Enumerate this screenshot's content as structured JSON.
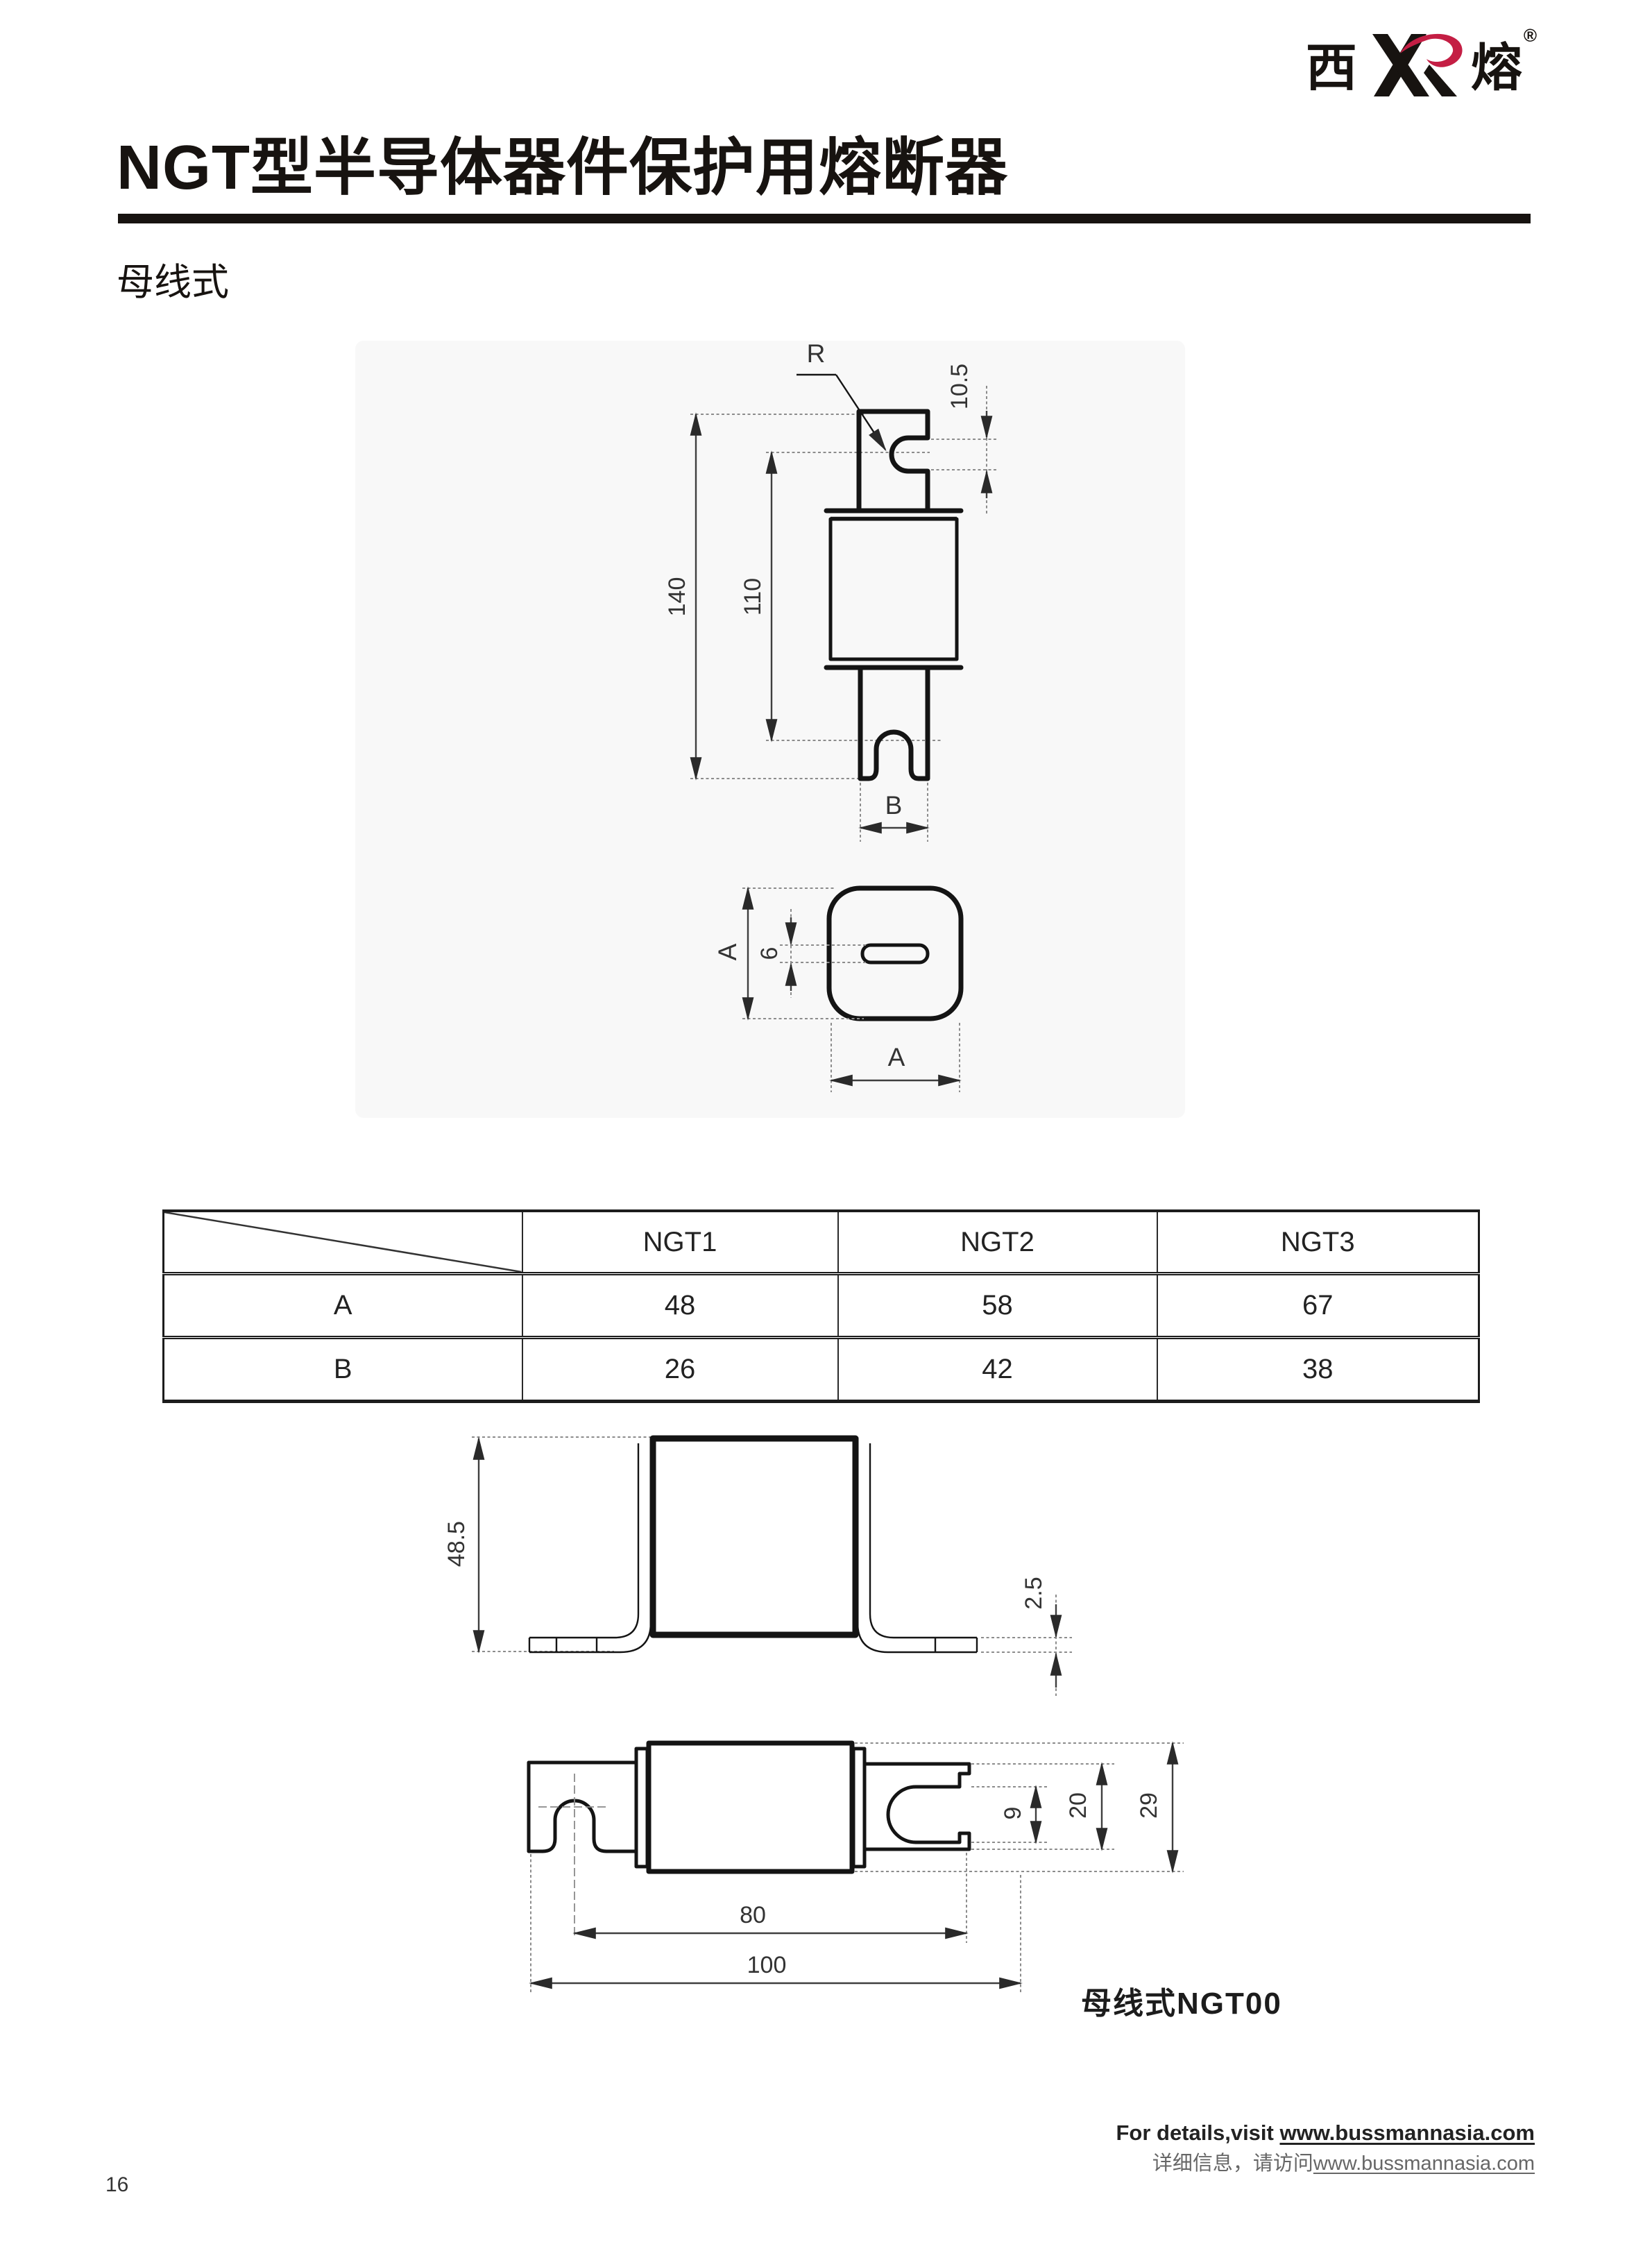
{
  "logo": {
    "left_char": "西",
    "right_char": "熔",
    "reg_mark": "®",
    "swoosh_color": "#c41e44"
  },
  "header": {
    "title": "NGT型半导体器件保护用熔断器",
    "subtitle": "母线式"
  },
  "table": {
    "col_headers": [
      "NGT1",
      "NGT2",
      "NGT3"
    ],
    "rows": [
      {
        "label": "A",
        "values": [
          "48",
          "58",
          "67"
        ]
      },
      {
        "label": "B",
        "values": [
          "26",
          "42",
          "38"
        ]
      }
    ]
  },
  "drawings": {
    "front_view": {
      "radius_label": "R",
      "slot_dim": "10.5",
      "overall_height": "140",
      "inner_height": "110",
      "blade_width": "B"
    },
    "top_view": {
      "side_dim_vertical": "A",
      "slot_width": "6",
      "side_dim_horizontal": "A"
    },
    "bracket_view": {
      "height": "48.5",
      "flange_thickness": "2.5"
    },
    "side_view": {
      "slot_gap": "9",
      "lip_span": "20",
      "blade_height": "29",
      "blade_span": "80",
      "overall_length": "100",
      "caption": "母线式NGT00"
    }
  },
  "footer": {
    "en_prefix": "For details,visit ",
    "en_url": "www.bussmannasia.com",
    "zh_prefix": "详细信息，请访问",
    "zh_url": "www.bussmannasia.com",
    "page_number": "16"
  }
}
